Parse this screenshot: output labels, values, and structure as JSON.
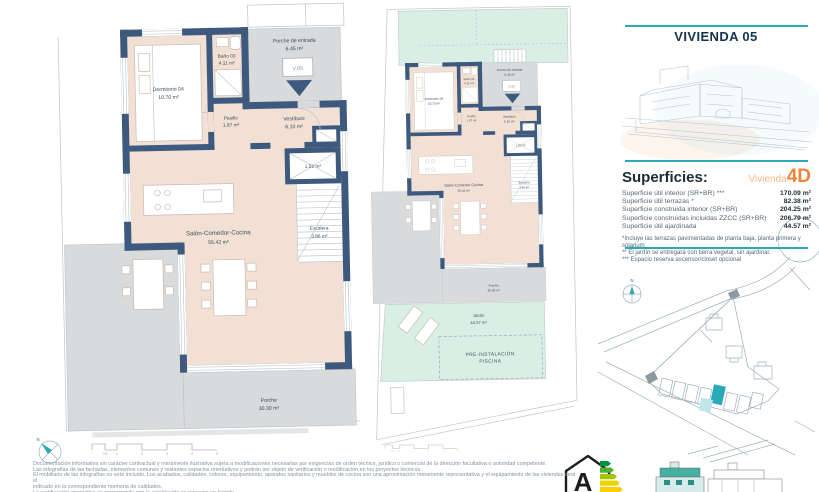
{
  "colors": {
    "wall": "#3d5a7e",
    "floor": "#f2e0d5",
    "porch_gray": "#d9dadb",
    "garden_green": "#d9efe6",
    "accent_teal": "#2aa9b8",
    "title_navy": "#16334d",
    "orange": "#ee8438",
    "orange_light": "#f5b888"
  },
  "header": {
    "title": "VIVIENDA 05"
  },
  "plan": {
    "unit_marker": "V.05",
    "rooms": {
      "porche_entrada": {
        "name": "Porche de entrada",
        "area": "6.45 m²"
      },
      "dormitorio_04": {
        "name": "Dormitorio 04",
        "area": "10.70 m²"
      },
      "bano_03": {
        "name": "Baño 03",
        "area": "4.11 m²"
      },
      "pasillo": {
        "name": "Pasillo",
        "area": "1.97 m²"
      },
      "vestibulo": {
        "name": "Vestíbulo",
        "area": "6.10 m²"
      },
      "reserva": {
        "area": "1.52 m²"
      },
      "salon": {
        "name": "Salón-Comedor-Cocina",
        "area": "55.42 m²"
      },
      "escalera": {
        "name": "Escalera",
        "area": "3.86 m²"
      },
      "porche": {
        "name": "Porche",
        "area": "30.30 m²"
      },
      "jardin": {
        "name": "Jardín",
        "area": "44.57 m²"
      },
      "piscina_line1": "PRE-INSTALACIÓN",
      "piscina_line2": "PISCINA"
    }
  },
  "superficies": {
    "heading": "Superficies:",
    "vivienda_label": "Vivienda",
    "vivienda_code": "4D",
    "rows": [
      {
        "label": "Superficie útil interior (SR+BR) ***",
        "value": "170.09 m²"
      },
      {
        "label": "Superficie útil terrazas *",
        "value": "82.38 m²"
      },
      {
        "label": "Superficie construida interior (SR+BR)",
        "value": "204.25 m²"
      },
      {
        "label": "Superficie construidas incluidas ZZCC (SR+BR)",
        "value": "206.79 m²"
      },
      {
        "label": "Superficie útil ajardinada",
        "value": "44.57 m²"
      }
    ],
    "footnotes": [
      "*Incluye las terrazas pavimentadas de planta baja, planta primera y solarium",
      "** El jardín se entregará con tierra vegetal, sin ajardinar.",
      "*** Espacio reserva ascensor/closet opcional"
    ]
  },
  "site_plan": {
    "north_label": "N"
  },
  "compass": {
    "north_label": "N"
  },
  "scale_bar": {
    "labels": [
      "0.5",
      "1",
      "2",
      "3",
      "4",
      "5"
    ]
  },
  "energy": {
    "rating": "A"
  },
  "disclaimer": {
    "lines": [
      "Documentación informativa sin carácter contractual y meramente ilustrativa sujeta a modificaciones necesarias por exigencias de orden técnico, jurídico o comercial de la dirección facultativa o autoridad competente.",
      "Las infografías de las fachadas, elementos comunes y restantes espacios orientativos y podrán ser objeto de verificación o modificación en los proyectos técnicos.",
      "El mobiliario de las infografías no está incluido. Los acabados, calidades, colores, equipamiento, aparatos sanitarios y muebles de cocina son una aproximación meramente representativa y el equipamiento de las viviendas será el",
      "indicado en la correspondiente memoria de calidades.",
      "La certificación energética se corresponde con la establecida en proyecto en trámite."
    ]
  }
}
